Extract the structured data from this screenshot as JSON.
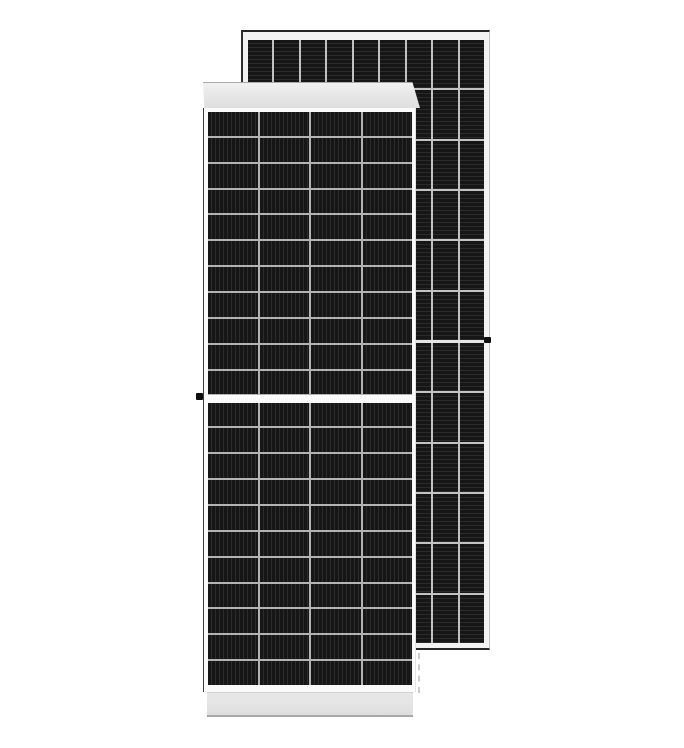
{
  "scene": {
    "description": "Product photo of two dark monocrystalline solar photovoltaic panels on a white background; one portrait panel in front, a second panel offset behind it to the upper right",
    "background_color": "#ffffff"
  },
  "colors": {
    "bg": "#ffffff",
    "cell_dark": "#161616",
    "cell_stripe": "#2b2b2b",
    "front_grid_line": "#b3b3b3",
    "back_grid_line": "#c2c2c2",
    "frame_white": "#fafafa",
    "frame_light": "#f2f2f2",
    "band_gray": "#e6e6e6",
    "dot": "#0e0e0e"
  },
  "front_panel": {
    "name": "Front solar panel, front view with half-cut cell layout",
    "columns": 4,
    "rows_per_half": 11,
    "halves": 2,
    "texture": "vertical busbar stripes",
    "features": [
      "light gray top frame band",
      "light gray bottom frame band",
      "white center gap between halves",
      "black grounding dot on left frame at mid-height"
    ]
  },
  "back_panel": {
    "name": "Rear solar panel, offset behind to the upper right",
    "columns": 9,
    "rows_per_half": 6,
    "halves": 2,
    "texture": "horizontal cell stripes",
    "features": [
      "white aluminum frame with dark outline",
      "center separator line",
      "black mounting dot on right frame at mid-height"
    ]
  }
}
